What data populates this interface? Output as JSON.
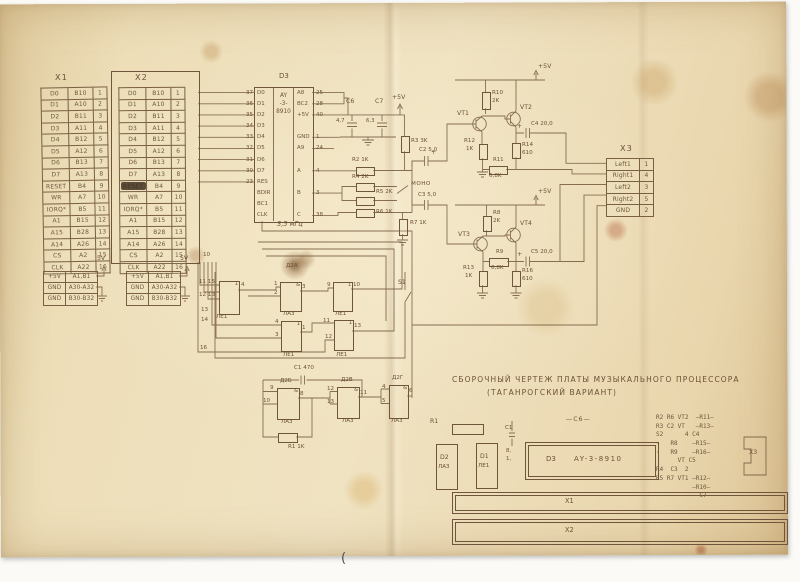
{
  "document": {
    "title_line1": "СБОРОЧНЫЙ ЧЕРТЕЖ ПЛАТЫ МУЗЫКАЛЬНОГО ПРОЦЕССОРА",
    "title_line2": "(ТАГАНРОГСКИЙ ВАРИАНТ)",
    "footer_mark": "(",
    "clock_label": "3,5 мГц"
  },
  "colors": {
    "paper": "#ecd9b2",
    "ink": "#6d5137",
    "stain": "#8a5a28",
    "pen": "#4a4a55"
  },
  "connector_x1": {
    "title": "X1",
    "rows": [
      {
        "sig": "D0",
        "pin": "B10",
        "num": "1"
      },
      {
        "sig": "D1",
        "pin": "A10",
        "num": "2"
      },
      {
        "sig": "D2",
        "pin": "B11",
        "num": "3"
      },
      {
        "sig": "D3",
        "pin": "A11",
        "num": "4"
      },
      {
        "sig": "D4",
        "pin": "B12",
        "num": "5"
      },
      {
        "sig": "D5",
        "pin": "A12",
        "num": "6"
      },
      {
        "sig": "D6",
        "pin": "B13",
        "num": "7"
      },
      {
        "sig": "D7",
        "pin": "A13",
        "num": "8"
      },
      {
        "sig": "RESET",
        "pin": "B4",
        "num": "9"
      },
      {
        "sig": "WR",
        "pin": "A7",
        "num": "10"
      },
      {
        "sig": "IORQ*",
        "pin": "B5",
        "num": "11"
      },
      {
        "sig": "A1",
        "pin": "B15",
        "num": "12"
      },
      {
        "sig": "A15",
        "pin": "B28",
        "num": "13"
      },
      {
        "sig": "A14",
        "pin": "A26",
        "num": "14"
      },
      {
        "sig": "CS",
        "pin": "A2",
        "num": "15"
      },
      {
        "sig": "CLK",
        "pin": "A22",
        "num": "16"
      }
    ]
  },
  "connector_x2": {
    "title": "X2",
    "rows": [
      {
        "sig": "D0",
        "pin": "B10",
        "num": "1"
      },
      {
        "sig": "D1",
        "pin": "A10",
        "num": "2"
      },
      {
        "sig": "D2",
        "pin": "B11",
        "num": "3"
      },
      {
        "sig": "D3",
        "pin": "A11",
        "num": "4"
      },
      {
        "sig": "D4",
        "pin": "B12",
        "num": "5"
      },
      {
        "sig": "D5",
        "pin": "A12",
        "num": "6"
      },
      {
        "sig": "D6",
        "pin": "B13",
        "num": "7"
      },
      {
        "sig": "D7",
        "pin": "A13",
        "num": "8"
      },
      {
        "sig": "RESET",
        "pin": "B4",
        "num": "9"
      },
      {
        "sig": "WR",
        "pin": "A7",
        "num": "10"
      },
      {
        "sig": "IORQ*",
        "pin": "B5",
        "num": "11"
      },
      {
        "sig": "A1",
        "pin": "B15",
        "num": "12"
      },
      {
        "sig": "A15",
        "pin": "B28",
        "num": "13"
      },
      {
        "sig": "A14",
        "pin": "A26",
        "num": "14"
      },
      {
        "sig": "CS",
        "pin": "A2",
        "num": "15"
      },
      {
        "sig": "CLK",
        "pin": "A22",
        "num": "16"
      }
    ]
  },
  "connector_x3": {
    "title": "X3",
    "rows": [
      {
        "sig": "Left1",
        "num": "1"
      },
      {
        "sig": "Right1",
        "num": "4"
      },
      {
        "sig": "Left2",
        "num": "3"
      },
      {
        "sig": "Right2",
        "num": "5"
      },
      {
        "sig": "GND",
        "num": "2"
      }
    ]
  },
  "power_left": {
    "arrow": "5V",
    "rows": [
      {
        "net": "+5V",
        "pins": "A1,B1"
      },
      {
        "net": "GND",
        "pins": "A30-A32"
      },
      {
        "net": "GND",
        "pins": "B30-B32"
      }
    ]
  },
  "power_right": {
    "arrow": "5V",
    "rows": [
      {
        "net": "+5V",
        "pins": "A1,B1"
      },
      {
        "net": "GND",
        "pins": "A30-A32"
      },
      {
        "net": "GND",
        "pins": "B30-B32"
      }
    ]
  },
  "chip_d3": {
    "ref": "D3",
    "name_lines": [
      {
        "l": "AY"
      },
      {
        "l": "-3-"
      },
      {
        "l": "8910"
      }
    ],
    "left_pins": [
      {
        "l": "D0",
        "n": "37"
      },
      {
        "l": "D1",
        "n": "36"
      },
      {
        "l": "D2",
        "n": "35"
      },
      {
        "l": "D3",
        "n": "34"
      },
      {
        "l": "D4",
        "n": "33"
      },
      {
        "l": "D5",
        "n": "32"
      },
      {
        "l": "D6",
        "n": "31"
      },
      {
        "l": "D7",
        "n": "30"
      },
      {
        "l": "RES",
        "n": "23"
      },
      {
        "l": "BDIR",
        "n": ""
      },
      {
        "l": "BC1",
        "n": ""
      },
      {
        "l": "CLK",
        "n": ""
      }
    ],
    "right_pins": [
      {
        "l": "A8",
        "n": "25"
      },
      {
        "l": "BC2",
        "n": "28"
      },
      {
        "l": "+5V",
        "n": "40"
      },
      {
        "l": "",
        "n": ""
      },
      {
        "l": "GND",
        "n": "1"
      },
      {
        "l": "A9",
        "n": "24"
      },
      {
        "l": "",
        "n": ""
      },
      {
        "l": "A",
        "n": "4"
      },
      {
        "l": "",
        "n": ""
      },
      {
        "l": "B",
        "n": "3"
      },
      {
        "l": "",
        "n": ""
      },
      {
        "l": "C",
        "n": "38"
      }
    ]
  },
  "mixer": {
    "c6": "C6",
    "c6_val": "4,7",
    "c7": "C7",
    "c7_val": "6,3",
    "vcc": "+5V",
    "r2": "R2 1K",
    "r4": "R4 2K",
    "r5": "R5 2K",
    "r6": "R6 1K",
    "r3": "R3 3K",
    "c2": "C2 5,0",
    "c2_plus": "+",
    "mono": "МОНО",
    "c3": "C3 5,0",
    "r7": "R7 1K",
    "s1": "S1"
  },
  "amp_top": {
    "vcc": "+5V",
    "r10": "R10",
    "r10_val": "2K",
    "vt1": "VT1",
    "vt2": "VT2",
    "r12": "R12",
    "r12_val": "1K",
    "r14": "R14",
    "r14_val": "610",
    "r11": "R11",
    "r11_val": "6,8K",
    "c4_plus": "+",
    "c4": "C4 20,0"
  },
  "amp_bottom": {
    "vcc": "+5V",
    "r8": "R8",
    "r8_val": "2K",
    "vt3": "VT3",
    "vt4": "VT4",
    "r13": "R13",
    "r13_val": "1K",
    "r16": "R16",
    "r16_val": "610",
    "r9": "R9",
    "r9_val": "6,8K",
    "c5_plus": "+",
    "c5": "C5 20,0"
  },
  "gates_top": {
    "bus": {
      "b1": "10",
      "b2": "11 15",
      "b3": "12 13",
      "b4": "13",
      "b5": "14",
      "b6": "16"
    },
    "g1": {
      "sym": "1",
      "out": "4",
      "type": "ЛЕ1"
    },
    "g2": {
      "ref": "Д2А",
      "sym": "&",
      "in1": "1",
      "in2": "2",
      "out": "3",
      "type": "ЛА3"
    },
    "g3": {
      "sym": "1",
      "in1": "9",
      "out": "10",
      "type": "ЛЕ1"
    },
    "g4": {
      "sym": "1",
      "in1": "4",
      "in2": "3",
      "out": "1",
      "type": "ЛЕ1"
    },
    "g5": {
      "sym": "1",
      "in1": "11",
      "in2": "12",
      "out": "13",
      "type": "ЛЕ1"
    }
  },
  "gates_bottom": {
    "c1": "C1 470",
    "r1": "R1 1K",
    "g6": {
      "ref": "Д2Б",
      "sym": "&",
      "in1": "9",
      "in2": "10",
      "out": "8",
      "type": "ЛА3"
    },
    "g7": {
      "ref": "Д2В",
      "sym": "&",
      "in1": "12",
      "in2": "13",
      "out": "11",
      "type": "ЛА3"
    },
    "g8": {
      "ref": "Д2Г",
      "sym": "&",
      "in1": "4",
      "in2": "5",
      "out": "6",
      "type": "ЛА3"
    }
  },
  "board": {
    "r1": "R1",
    "c1": "C1",
    "c1_m1": "8,",
    "c1_m2": "1,",
    "c6": "—C6—",
    "d2_ref": "D2",
    "d2_type": "ЛА3",
    "d1_ref": "D1",
    "d1_type": "ЛЕ1",
    "d3_ref": "D3",
    "d3_name": "AY-3-8910",
    "x1": "X1",
    "x2": "X2",
    "x3": "X3",
    "right_column": [
      {
        "t": "R2 R6 VT2  —R11—"
      },
      {
        "t": "R3 C2 VT   —R13—"
      },
      {
        "t": "S2      4 C4"
      },
      {
        "t": "·   R8    —R15—"
      },
      {
        "t": "·   R9    —R16—"
      },
      {
        "t": "      VT C5"
      },
      {
        "t": "R4  C3  2"
      },
      {
        "t": "R5 R7 VT1 —R12—"
      },
      {
        "t": "          —R10—"
      },
      {
        "t": "           —C7—"
      }
    ]
  }
}
